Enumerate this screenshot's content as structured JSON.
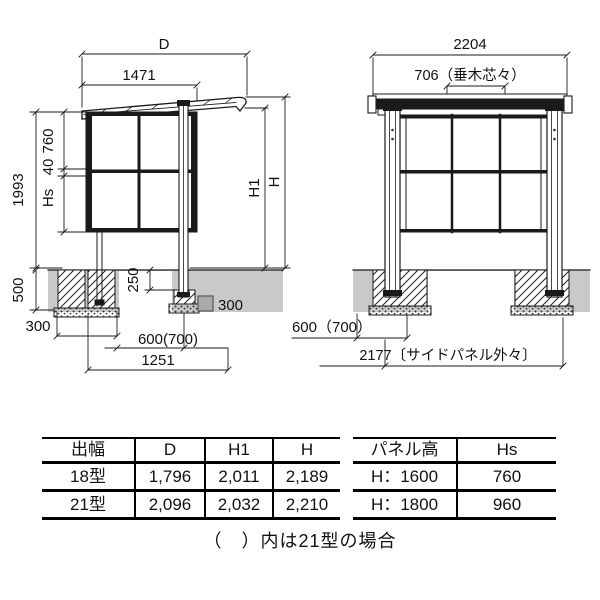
{
  "colors": {
    "line": "#1a1a1a",
    "ground": "#c9c9c9",
    "footing_symbol": "#ababab"
  },
  "side_view": {
    "labels": {
      "d": "D",
      "w1471": "1471",
      "h1993": "1993",
      "p760": "760",
      "p40": "40",
      "hs": "Hs",
      "f500": "500",
      "w300": "300",
      "e250": "250",
      "sq300": "300",
      "off600": "600(700)",
      "d1251": "1251",
      "h1": "H1",
      "h": "H"
    }
  },
  "front_view": {
    "labels": {
      "w2204": "2204",
      "rafter706": "706（垂木芯々）",
      "off600": "600（700）",
      "panel2177": "2177〔サイドパネル外々〕"
    }
  },
  "tables": {
    "size": {
      "headers": [
        "出幅",
        "D",
        "H1",
        "H"
      ],
      "rows": [
        [
          "18型",
          "1,796",
          "2,011",
          "2,189"
        ],
        [
          "21型",
          "2,096",
          "2,032",
          "2,210"
        ]
      ]
    },
    "panel": {
      "headers": [
        "パネル高",
        "Hs"
      ],
      "rows": [
        [
          "H：1600",
          "760"
        ],
        [
          "H：1800",
          "960"
        ]
      ]
    }
  },
  "footnote": "（　）内は21型の場合"
}
